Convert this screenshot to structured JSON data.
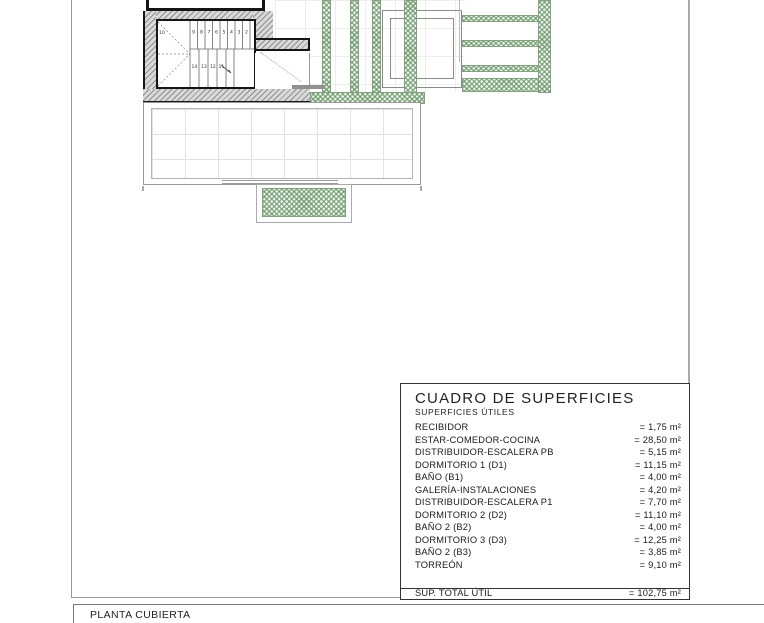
{
  "page": {
    "footer_title": "PLANTA CUBIERTA"
  },
  "surface_table": {
    "title": "CUADRO DE SUPERFICIES",
    "subtitle": "SUPERFICIES ÚTILES",
    "rows": [
      {
        "label": "RECIBIDOR",
        "value": "= 1,75 m²"
      },
      {
        "label": "ESTAR-COMEDOR-COCINA",
        "value": "= 28,50 m²"
      },
      {
        "label": "DISTRIBUIDOR-ESCALERA PB",
        "value": "= 5,15 m²"
      },
      {
        "label": "DORMITORIO 1 (D1)",
        "value": "= 11,15 m²"
      },
      {
        "label": "BAÑO  (B1)",
        "value": "= 4,00 m²"
      },
      {
        "label": "GALERÍA-INSTALACIONES",
        "value": "= 4,20 m²"
      },
      {
        "label": "DISTRIBUIDOR-ESCALERA P1",
        "value": "= 7,70 m²"
      },
      {
        "label": "DORMITORIO 2 (D2)",
        "value": "= 11,10 m²"
      },
      {
        "label": "BAÑO 2 (B2)",
        "value": "= 4,00 m²"
      },
      {
        "label": "DORMITORIO 3 (D3)",
        "value": "= 12,25 m²"
      },
      {
        "label": "BAÑO 2 (B3)",
        "value": "= 3,85 m²"
      },
      {
        "label": "TORREÓN",
        "value": "= 9,10 m²"
      }
    ],
    "total_label": "SUP. TOTAL ÚTIL",
    "total_value": "= 102,75 m²"
  },
  "plan": {
    "stair": {
      "landing": "10",
      "upper": [
        "9",
        "8",
        "7",
        "6",
        "5",
        "4",
        "3",
        "2"
      ],
      "lower": [
        "14",
        "13",
        "12",
        "11"
      ]
    }
  },
  "colors": {
    "green_hatch": "#6f9a6f",
    "wall_hatch_dark": "#8f8f8f",
    "wall_hatch_light": "#d9d9d9",
    "outline_black": "#151515",
    "outline_gray": "#999999"
  }
}
